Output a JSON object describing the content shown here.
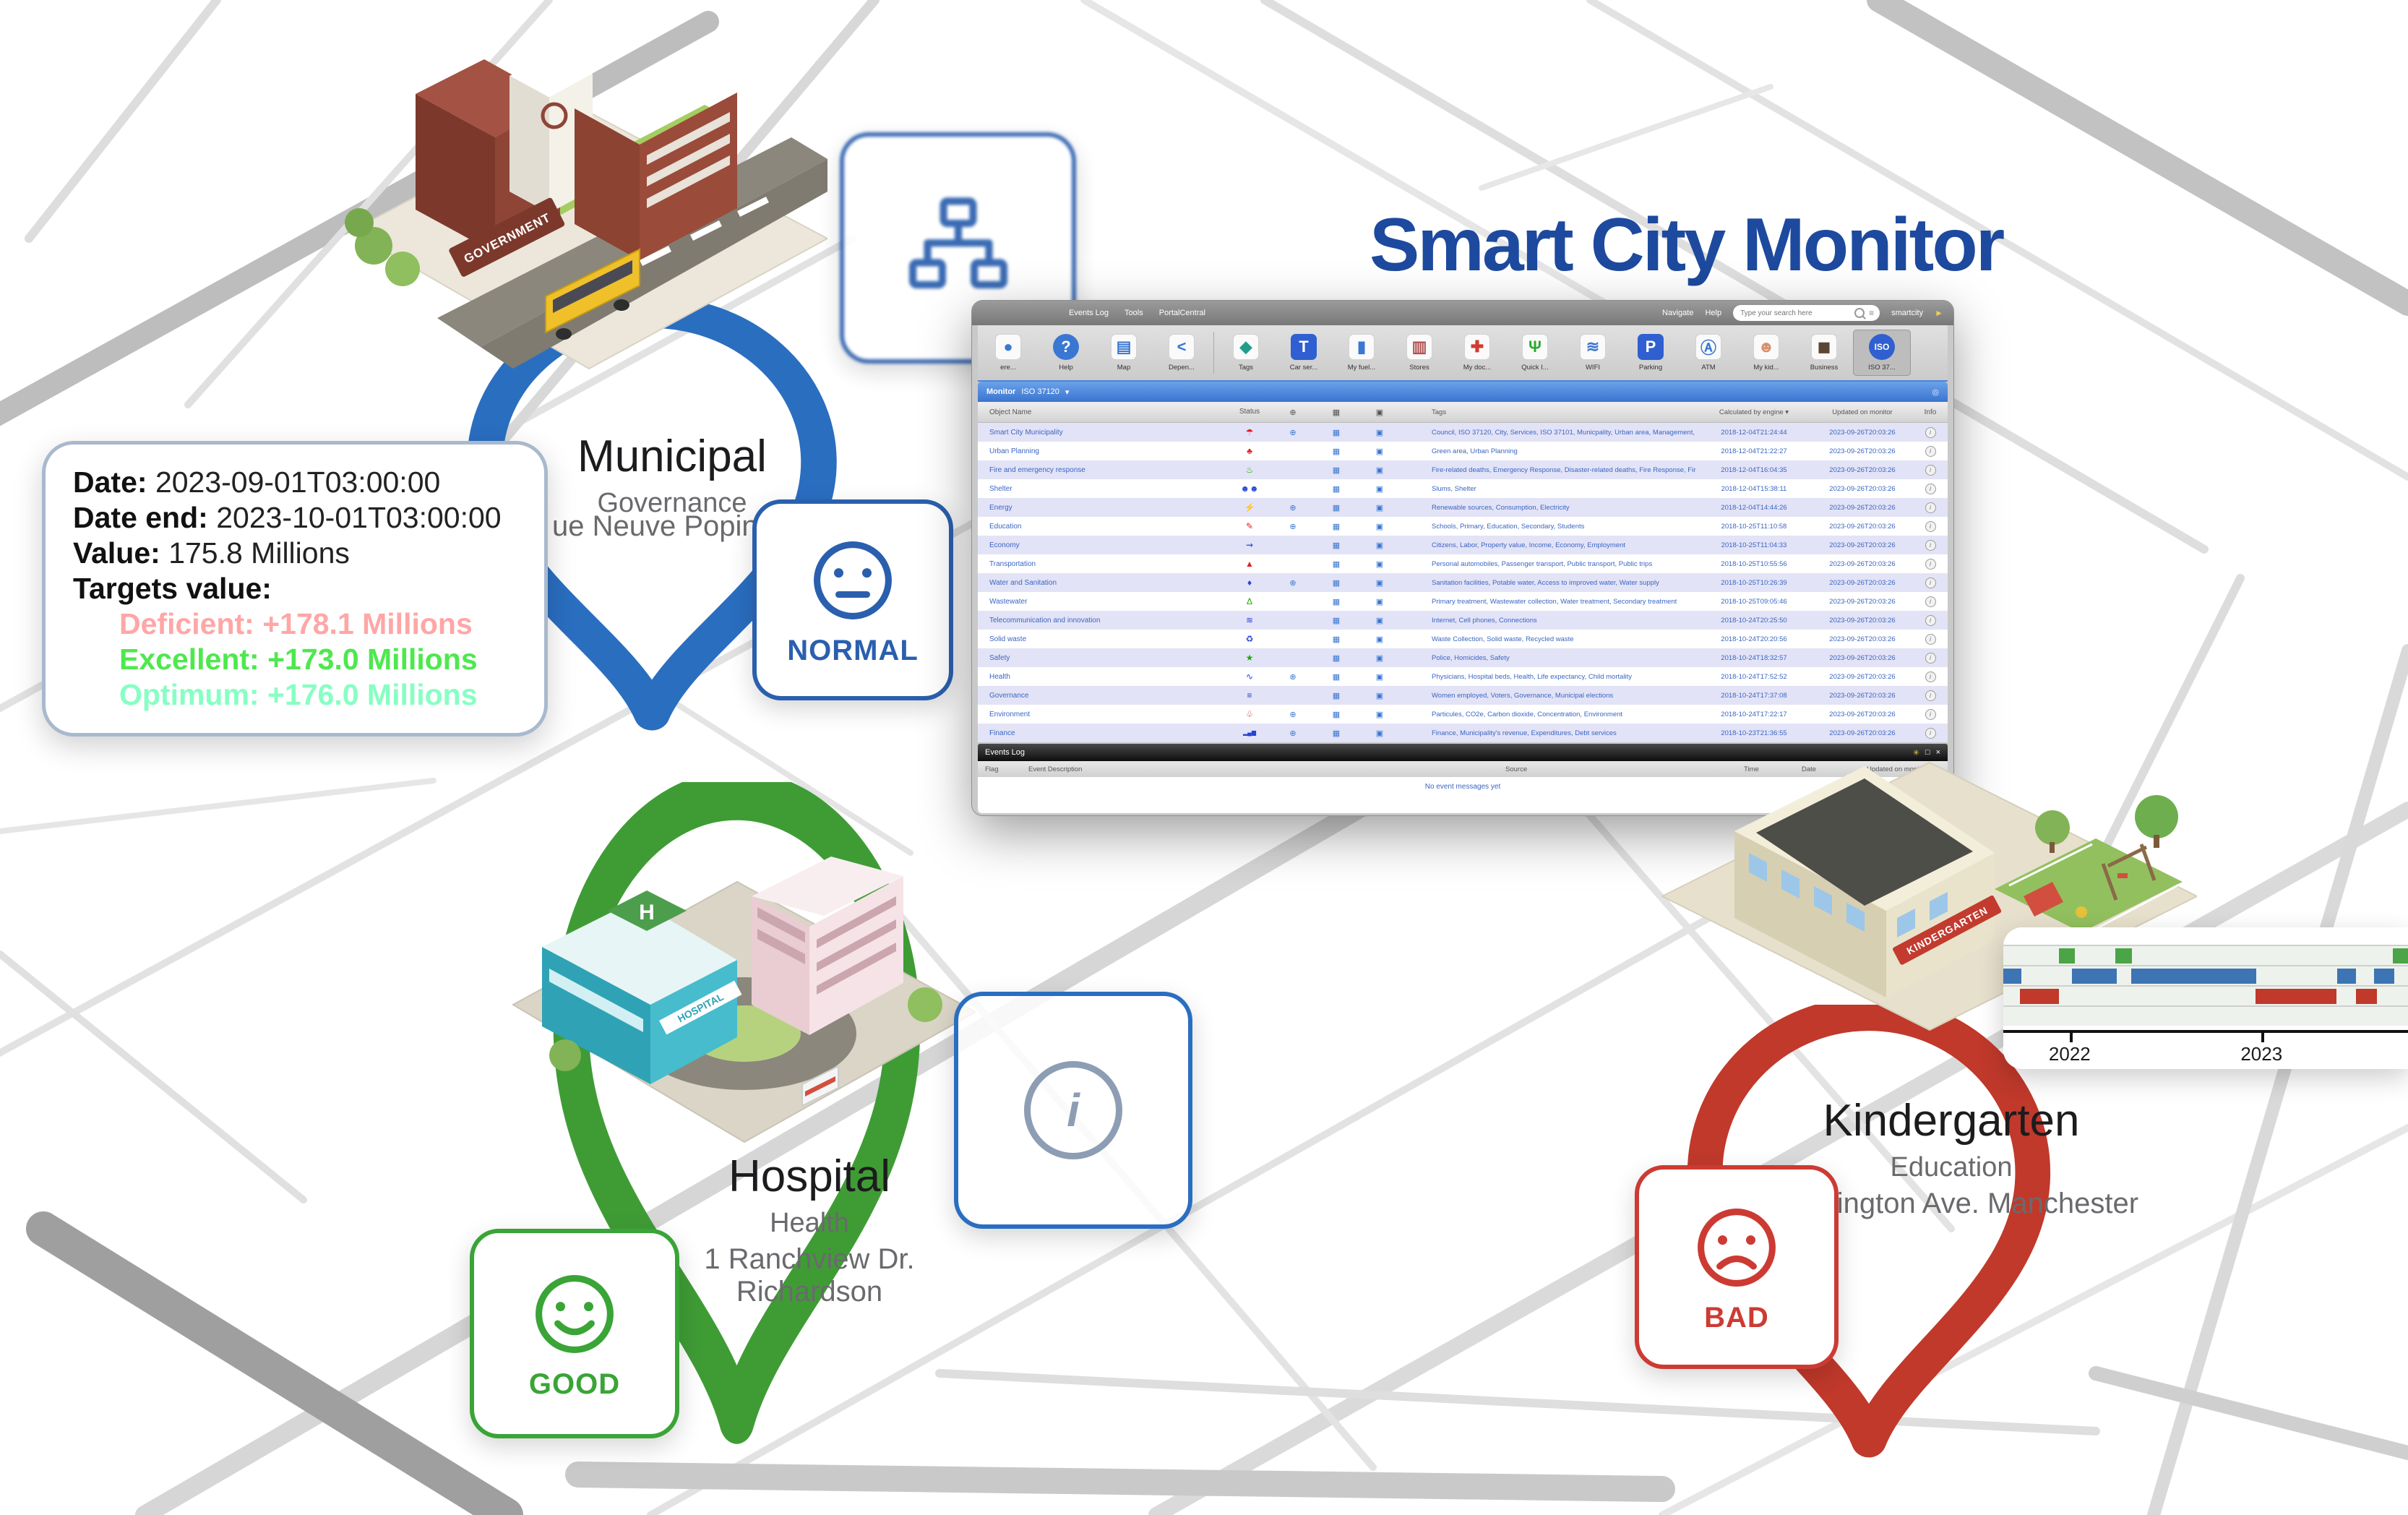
{
  "page_title": "Smart City Monitor",
  "colors": {
    "brand_blue": "#1d4a9e"
  },
  "pins": {
    "municipal": {
      "color": "#2a6ec0"
    },
    "hospital": {
      "color": "#3f9c35"
    },
    "kindergarten": {
      "color": "#c0392b"
    }
  },
  "badges": {
    "hierarchy": {
      "color": "#2a5fae"
    },
    "normal": {
      "label": "NORMAL",
      "color": "#2a5fae"
    },
    "good": {
      "label": "GOOD",
      "color": "#3aa437"
    },
    "bad": {
      "label": "BAD",
      "color": "#cc3b33"
    },
    "info": {
      "letter": "i",
      "color": "#8d9db4"
    }
  },
  "locations": {
    "municipal": {
      "name": "Municipal",
      "category": "Governance",
      "address": "ue Neuve Popincourt 75009",
      "sign": "GOVERNMENT"
    },
    "hospital": {
      "name": "Hospital",
      "category": "Health",
      "address": "1 Ranchview Dr. Richardson",
      "sign": "HOSPITAL"
    },
    "kindergarten": {
      "name": "Kindergarten",
      "category": "Education",
      "address": "Washington Ave. Manchester",
      "sign": "KINDERGARTEN"
    }
  },
  "tooltip": {
    "date_label": "Date:",
    "date": "2023-09-01T03:00:00",
    "date_end_label": "Date end:",
    "date_end": "2023-10-01T03:00:00",
    "value_label": "Value:",
    "value": "175.8 Millions",
    "targets_label": "Targets value:",
    "targets": [
      {
        "label": "Deficient:",
        "value": "+178.1 Millions",
        "color": "#ffa6a6"
      },
      {
        "label": "Excellent:",
        "value": "+173.0 Millions",
        "color": "#4ee84e"
      },
      {
        "label": "Optimum:",
        "value": "+176.0 Millions",
        "color": "#86ffc3"
      }
    ]
  },
  "app": {
    "menu_left": [
      "Events Log",
      "Tools",
      "PortalCentral"
    ],
    "menu_right": [
      "Navigate",
      "Help"
    ],
    "search_placeholder": "Type your search here",
    "username": "smartcity",
    "icons": {
      "globe-icon": "⊕",
      "film-icon": "▦",
      "image-icon": "▣",
      "caret-down-icon": "▾",
      "eye-icon": "◎",
      "menu-lines-icon": "≡",
      "cursor-icon": "►",
      "info-icon": "i"
    },
    "toolbar": [
      {
        "label": "ere...",
        "icon": "circle-icon",
        "glyph": "●",
        "color": "#3a77d2",
        "chip": false
      },
      {
        "label": "Help",
        "icon": "help-icon",
        "glyph": "?",
        "color": "#3a77d2",
        "chip": true,
        "round": true
      },
      {
        "label": "Map",
        "icon": "map-icon",
        "glyph": "▤",
        "color": "#3a77d2",
        "chip": false
      },
      {
        "label": "Depen...",
        "icon": "share-icon",
        "glyph": "<",
        "color": "#3a77d2",
        "chip": false,
        "sep_after": true
      },
      {
        "label": "Tags",
        "icon": "tag-icon",
        "glyph": "◆",
        "color": "#1f9e8e",
        "chip": false
      },
      {
        "label": "Car ser...",
        "icon": "car-service-icon",
        "glyph": "T",
        "color": "#2f5fd0",
        "chip": true
      },
      {
        "label": "My fuel...",
        "icon": "fuel-icon",
        "glyph": "▮",
        "color": "#3a77d2",
        "chip": false
      },
      {
        "label": "Stores",
        "icon": "stores-icon",
        "glyph": "▥",
        "color": "#b05050",
        "chip": false
      },
      {
        "label": "My doc...",
        "icon": "medical-cross-icon",
        "glyph": "✚",
        "color": "#d23b2f",
        "chip": false
      },
      {
        "label": "Quick I...",
        "icon": "food-icon",
        "glyph": "Ψ",
        "color": "#2daa2d",
        "chip": false
      },
      {
        "label": "WIFI",
        "icon": "wifi-icon",
        "glyph": "≋",
        "color": "#3a77d2",
        "chip": false
      },
      {
        "label": "Parking",
        "icon": "parking-icon",
        "glyph": "P",
        "color": "#2f5fd0",
        "chip": true
      },
      {
        "label": "ATM",
        "icon": "atm-icon",
        "glyph": "Ⓐ",
        "color": "#3a77d2",
        "chip": false
      },
      {
        "label": "My kid...",
        "icon": "kid-icon",
        "glyph": "☻",
        "color": "#d98f6a",
        "chip": false
      },
      {
        "label": "Business",
        "icon": "briefcase-icon",
        "glyph": "◼",
        "color": "#5a4632",
        "chip": false
      },
      {
        "label": "ISO 37...",
        "icon": "iso-icon",
        "glyph": "ISO",
        "color": "#2f5fd0",
        "chip": true,
        "round": true,
        "selected": true
      }
    ],
    "panel_title": "Monitor",
    "panel_filter": "ISO 37120",
    "columns": [
      "Object Name",
      "Status",
      "Tags",
      "Calculated by engine ▾",
      "Updated on monitor",
      "Info"
    ],
    "updated_on_monitor": "2023-09-26T20:03:26",
    "rows": [
      {
        "name": "Smart City Municipality",
        "icon": "umbrella-icon",
        "glyph": "☂",
        "color": "#e02020",
        "globe": true,
        "tags": "Council, ISO 37120, City, Services, ISO 37101, Municpality, Urban area, Management, Benchmarking",
        "calculated": "2018-12-04T21:24:44"
      },
      {
        "name": "Urban Planning",
        "icon": "tree-icon",
        "glyph": "♣",
        "color": "#e02020",
        "globe": false,
        "tags": "Green area, Urban Planning",
        "calculated": "2018-12-04T21:22:27"
      },
      {
        "name": "Fire and emergency response",
        "icon": "flame-icon",
        "glyph": "♨",
        "color": "#1faa00",
        "globe": false,
        "tags": "Fire-related deaths, Emergency Response, Disaster-related deaths, Fire Response, Firefighters",
        "calculated": "2018-12-04T16:04:35"
      },
      {
        "name": "Shelter",
        "icon": "people-icon",
        "glyph": "☻☻",
        "color": "#2741d6",
        "globe": false,
        "tags": "Slums, Shelter",
        "calculated": "2018-12-04T15:38:11"
      },
      {
        "name": "Energy",
        "icon": "plug-icon",
        "glyph": "⚡",
        "color": "#1faa00",
        "globe": true,
        "tags": "Renewable sources, Consumption, Electricity",
        "calculated": "2018-12-04T14:44:26"
      },
      {
        "name": "Education",
        "icon": "graduation-cap-icon",
        "glyph": "✎",
        "color": "#e02020",
        "globe": true,
        "tags": "Schools, Primary, Education, Secondary, Students",
        "calculated": "2018-10-25T11:10:58"
      },
      {
        "name": "Economy",
        "icon": "waves-arrow-icon",
        "glyph": "⇝",
        "color": "#2741d6",
        "globe": false,
        "tags": "Citizens, Labor, Property value, Income, Economy, Employment",
        "calculated": "2018-10-25T11:04:33"
      },
      {
        "name": "Transportation",
        "icon": "traffic-cone-icon",
        "glyph": "▲",
        "color": "#e02020",
        "globe": false,
        "tags": "Personal automobiles, Passenger transport, Public transport, Public trips",
        "calculated": "2018-10-25T10:55:56"
      },
      {
        "name": "Water and Sanitation",
        "icon": "droplet-icon",
        "glyph": "♦",
        "color": "#2741d6",
        "globe": true,
        "tags": "Sanitation facilities, Potable water, Access to improved water, Water supply",
        "calculated": "2018-10-25T10:26:39"
      },
      {
        "name": "Wastewater",
        "icon": "flask-icon",
        "glyph": "Δ",
        "color": "#1faa00",
        "globe": false,
        "tags": "Primary treatment, Wastewater collection, Water treatment, Secondary treatment",
        "calculated": "2018-10-25T09:05:46"
      },
      {
        "name": "Telecommunication and innovation",
        "icon": "wifi-icon",
        "glyph": "≋",
        "color": "#2741d6",
        "globe": false,
        "tags": "Internet, Cell phones, Connections",
        "calculated": "2018-10-24T20:25:50"
      },
      {
        "name": "Solid waste",
        "icon": "trash-icon",
        "glyph": "♻",
        "color": "#2741d6",
        "globe": false,
        "tags": "Waste Collection, Solid waste, Recycled waste",
        "calculated": "2018-10-24T20:20:56"
      },
      {
        "name": "Safety",
        "icon": "lock-icon",
        "glyph": "★",
        "color": "#1faa00",
        "globe": false,
        "tags": "Police, Homicides, Safety",
        "calculated": "2018-10-24T18:32:57"
      },
      {
        "name": "Health",
        "icon": "pulse-icon",
        "glyph": "∿",
        "color": "#2741d6",
        "globe": true,
        "tags": "Physicians, Hospital beds, Health, Life expectancy, Child mortality",
        "calculated": "2018-10-24T17:52:52"
      },
      {
        "name": "Governance",
        "icon": "layers-icon",
        "glyph": "≡",
        "color": "#2741d6",
        "globe": false,
        "tags": "Women employed, Voters, Governance, Municipal elections",
        "calculated": "2018-10-24T17:37:08"
      },
      {
        "name": "Environment",
        "icon": "leaf-icon",
        "glyph": "♧",
        "color": "#e02020",
        "globe": true,
        "tags": "Particules, CO2e, Carbon dioxide, Concentration, Environment",
        "calculated": "2018-10-24T17:22:17"
      },
      {
        "name": "Finance",
        "icon": "bar-chart-icon",
        "glyph": "▂▄▆",
        "color": "#2741d6",
        "globe": true,
        "tags": "Finance, Municipality's revenue, Expenditures, Debt services",
        "calculated": "2018-10-23T21:36:55"
      }
    ],
    "events_log": {
      "title": "Events Log",
      "columns": [
        "Flag",
        "Event Description",
        "Source",
        "Time",
        "Date",
        "Updated on monitor ▾"
      ],
      "empty_message": "No event messages yet",
      "controls": [
        {
          "name": "flag-control-icon",
          "glyph": "✳",
          "color": "#e8c84a"
        },
        {
          "name": "maximize-icon",
          "glyph": "□",
          "color": "#ffffff"
        },
        {
          "name": "close-icon",
          "glyph": "×",
          "color": "#ffffff"
        }
      ]
    }
  },
  "chart_data": {
    "type": "timeline",
    "title": "",
    "x_ticks": [
      {
        "label": "2022",
        "pos_pct": 16.4
      },
      {
        "label": "2023",
        "pos_pct": 63.8
      }
    ],
    "lanes": [
      {
        "name": "lane-1",
        "color": "#4ba446",
        "segments_pct": [
          [
            13.7,
            17.6
          ],
          [
            27.7,
            31.8
          ],
          [
            96.3,
            100
          ]
        ]
      },
      {
        "name": "lane-2",
        "color": "#3d74b4",
        "segments_pct": [
          [
            0,
            4.5
          ],
          [
            17.0,
            28.0
          ],
          [
            31.6,
            62.5
          ],
          [
            82.5,
            87.1
          ],
          [
            91.6,
            96.6
          ]
        ]
      },
      {
        "name": "lane-3",
        "color": "#c0392b",
        "segments_pct": [
          [
            4.1,
            13.7
          ],
          [
            62.3,
            82.3
          ],
          [
            87.1,
            92.3
          ]
        ]
      },
      {
        "name": "lane-4",
        "color": "#c0392b",
        "segments_pct": []
      }
    ]
  }
}
